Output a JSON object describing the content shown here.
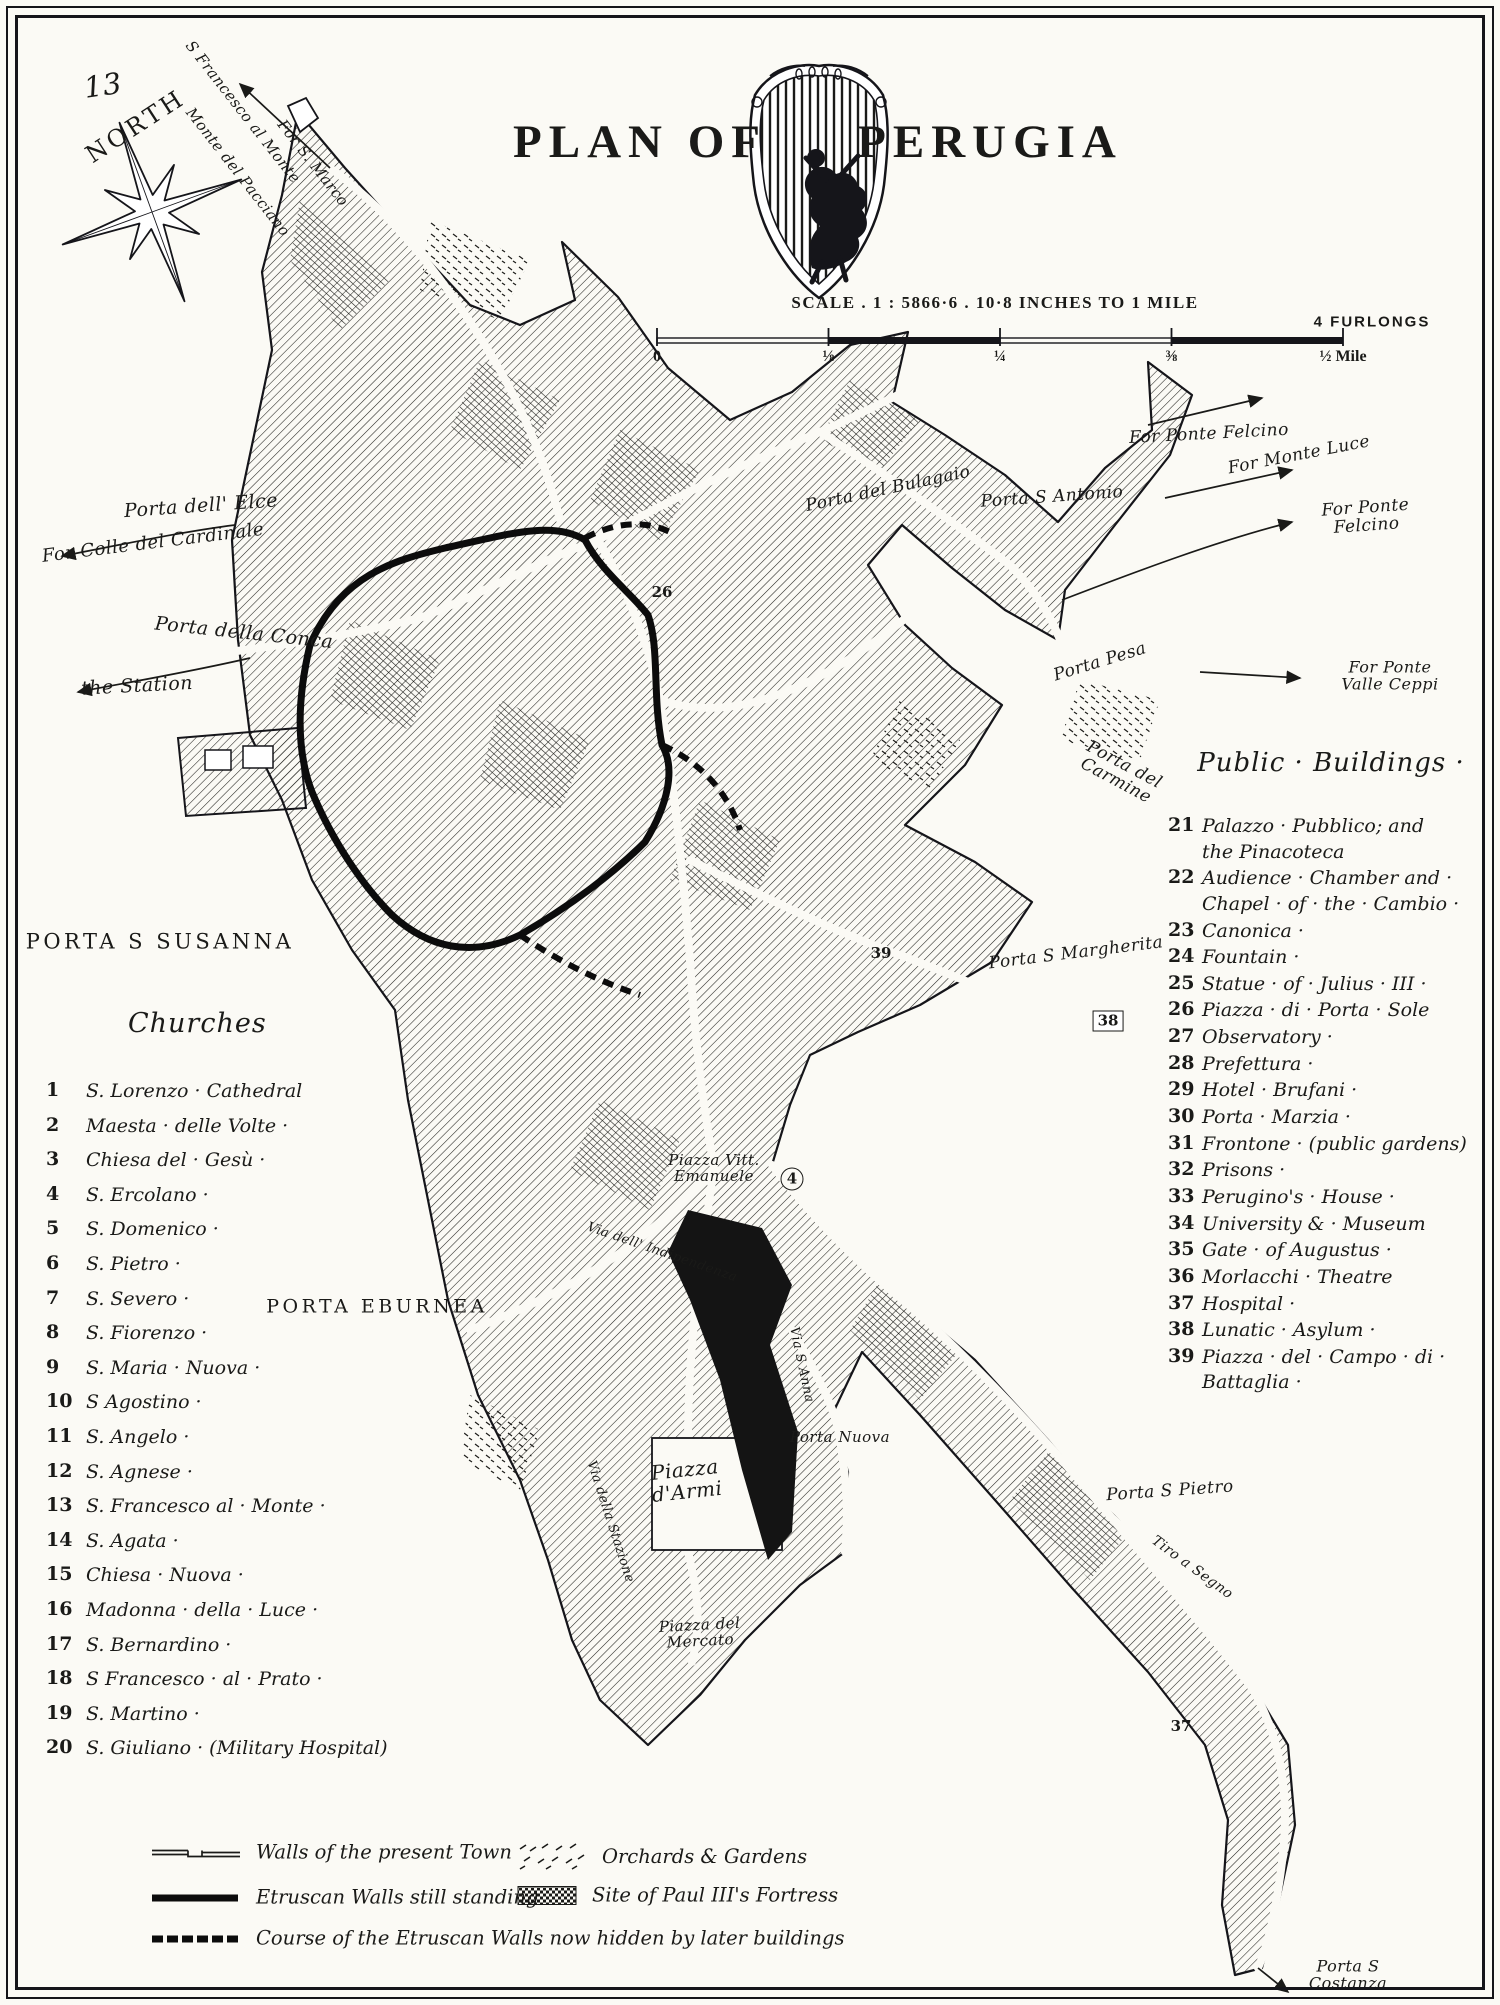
{
  "title": {
    "plan_of": "PLAN OF",
    "perugia": "PERUGIA"
  },
  "compass": {
    "label": "NORTH",
    "page_number": "13"
  },
  "scale": {
    "caption": "SCALE . 1 : 5866·6 . 10·8 INCHES TO 1 MILE",
    "furlongs": "4 FURLONGS",
    "ticks": [
      "0",
      "⅛",
      "¼",
      "⅜",
      "½ Mile"
    ]
  },
  "churches": {
    "heading": "Churches",
    "items": [
      {
        "num": "1",
        "name": "S. Lorenzo · Cathedral"
      },
      {
        "num": "2",
        "name": "Maesta · delle Volte ·"
      },
      {
        "num": "3",
        "name": "Chiesa del · Gesù ·"
      },
      {
        "num": "4",
        "name": "S. Ercolano ·"
      },
      {
        "num": "5",
        "name": "S. Domenico ·"
      },
      {
        "num": "6",
        "name": "S. Pietro ·"
      },
      {
        "num": "7",
        "name": "S. Severo ·"
      },
      {
        "num": "8",
        "name": "S. Fiorenzo ·"
      },
      {
        "num": "9",
        "name": "S. Maria · Nuova ·"
      },
      {
        "num": "10",
        "name": "S Agostino ·"
      },
      {
        "num": "11",
        "name": "S. Angelo ·"
      },
      {
        "num": "12",
        "name": "S. Agnese ·"
      },
      {
        "num": "13",
        "name": "S. Francesco al · Monte ·"
      },
      {
        "num": "14",
        "name": "S. Agata ·"
      },
      {
        "num": "15",
        "name": "Chiesa · Nuova ·"
      },
      {
        "num": "16",
        "name": "Madonna · della · Luce ·"
      },
      {
        "num": "17",
        "name": "S. Bernardino ·"
      },
      {
        "num": "18",
        "name": "S Francesco · al · Prato ·"
      },
      {
        "num": "19",
        "name": "S. Martino ·"
      },
      {
        "num": "20",
        "name": "S. Giuliano · (Military Hospital)"
      }
    ]
  },
  "public_buildings": {
    "heading": "Public · Buildings ·",
    "items": [
      {
        "num": "21",
        "name": "Palazzo · Pubblico; and\nthe Pinacoteca"
      },
      {
        "num": "22",
        "name": "Audience · Chamber and ·\nChapel · of · the · Cambio ·"
      },
      {
        "num": "23",
        "name": "Canonica ·"
      },
      {
        "num": "24",
        "name": "Fountain ·"
      },
      {
        "num": "25",
        "name": "Statue · of · Julius · III ·"
      },
      {
        "num": "26",
        "name": "Piazza · di · Porta · Sole"
      },
      {
        "num": "27",
        "name": "Observatory ·"
      },
      {
        "num": "28",
        "name": "Prefettura ·"
      },
      {
        "num": "29",
        "name": "Hotel · Brufani ·"
      },
      {
        "num": "30",
        "name": "Porta · Marzia ·"
      },
      {
        "num": "31",
        "name": "Frontone · (public gardens)"
      },
      {
        "num": "32",
        "name": "Prisons ·"
      },
      {
        "num": "33",
        "name": "Perugino's · House ·"
      },
      {
        "num": "34",
        "name": "University & · Museum"
      },
      {
        "num": "35",
        "name": "Gate · of Augustus ·"
      },
      {
        "num": "36",
        "name": "Morlacchi · Theatre"
      },
      {
        "num": "37",
        "name": "Hospital ·"
      },
      {
        "num": "38",
        "name": "Lunatic · Asylum ·"
      },
      {
        "num": "39",
        "name": "Piazza · del · Campo · di ·\nBattaglia ·"
      }
    ]
  },
  "legend": {
    "col1": [
      {
        "key": "present-walls",
        "label": "Walls of the present Town"
      },
      {
        "key": "etruscan-walls",
        "label": "Etruscan Walls still standing"
      },
      {
        "key": "etruscan-hidden",
        "label": "Course of the Etruscan Walls now hidden by later buildings"
      }
    ],
    "col2": [
      {
        "key": "orchards",
        "label": "Orchards & Gardens"
      },
      {
        "key": "fortress",
        "label": "Site of Paul III's Fortress"
      }
    ]
  },
  "map_labels": [
    {
      "text": "13",
      "x": 103,
      "y": 86,
      "rot": -8,
      "fs": 29
    },
    {
      "text": "NORTH",
      "x": 136,
      "y": 127,
      "rot": -33,
      "fs": 24,
      "cls": "caps"
    },
    {
      "text": "S Francesco al Monte",
      "x": 243,
      "y": 112,
      "rot": 52,
      "fs": 15
    },
    {
      "text": "Monte del Pacciano",
      "x": 238,
      "y": 172,
      "rot": 52,
      "fs": 15
    },
    {
      "text": "For S. Marco",
      "x": 313,
      "y": 163,
      "rot": 52,
      "fs": 15
    },
    {
      "text": "Porta dell' Elce",
      "x": 201,
      "y": 506,
      "rot": -4,
      "fs": 19
    },
    {
      "text": "For Colle del Cardinale",
      "x": 153,
      "y": 543,
      "rot": -7,
      "fs": 18
    },
    {
      "text": "Porta della Conca",
      "x": 244,
      "y": 633,
      "rot": 6,
      "fs": 19
    },
    {
      "text": "the Station",
      "x": 137,
      "y": 686,
      "rot": -3,
      "fs": 19
    },
    {
      "text": "Porta del Bulagaio",
      "x": 888,
      "y": 489,
      "rot": -12,
      "fs": 17
    },
    {
      "text": "Porta S Antonio",
      "x": 1052,
      "y": 497,
      "rot": -4,
      "fs": 17
    },
    {
      "text": "For Ponte Felcino",
      "x": 1209,
      "y": 434,
      "rot": -3,
      "fs": 17
    },
    {
      "text": "For Monte Luce",
      "x": 1299,
      "y": 455,
      "rot": -11,
      "fs": 17
    },
    {
      "text": "For Ponte Felcino",
      "x": 1366,
      "y": 517,
      "rot": -4,
      "fs": 17
    },
    {
      "text": "Porta Pesa",
      "x": 1100,
      "y": 662,
      "rot": -17,
      "fs": 17
    },
    {
      "text": "For Ponte Valle Ceppi",
      "x": 1390,
      "y": 676,
      "rot": 0,
      "fs": 16
    },
    {
      "text": "Porta del\nCarmine",
      "x": 1120,
      "y": 773,
      "rot": 28,
      "fs": 17
    },
    {
      "text": "Porta S Margherita",
      "x": 1076,
      "y": 953,
      "rot": -7,
      "fs": 17
    },
    {
      "text": "PORTA S SUSANNA",
      "x": 160,
      "y": 942,
      "rot": 0,
      "fs": 21,
      "cls": "caps"
    },
    {
      "text": "PORTA EBURNEA",
      "x": 377,
      "y": 1307,
      "rot": 0,
      "fs": 19,
      "cls": "caps"
    },
    {
      "text": "Piazza Vitt.\nEmanuele",
      "x": 714,
      "y": 1168,
      "rot": 0,
      "fs": 15
    },
    {
      "text": "Via dell' Indipendenza",
      "x": 662,
      "y": 1253,
      "rot": 19,
      "fs": 13
    },
    {
      "text": "Via S Anna",
      "x": 801,
      "y": 1365,
      "rot": 78,
      "fs": 13
    },
    {
      "text": "Porta Nuova",
      "x": 840,
      "y": 1437,
      "rot": 0,
      "fs": 15
    },
    {
      "text": "Piazza\nd'Armi",
      "x": 686,
      "y": 1481,
      "rot": -6,
      "fs": 20
    },
    {
      "text": "Via della Stazione",
      "x": 610,
      "y": 1522,
      "rot": 72,
      "fs": 13
    },
    {
      "text": "Piazza del\nMercato",
      "x": 700,
      "y": 1633,
      "rot": -3,
      "fs": 15
    },
    {
      "text": "Porta S Pietro",
      "x": 1170,
      "y": 1491,
      "rot": -4,
      "fs": 17
    },
    {
      "text": "Tiro a Segno",
      "x": 1192,
      "y": 1568,
      "rot": 36,
      "fs": 14
    },
    {
      "text": "Porta S\nCostanza",
      "x": 1348,
      "y": 1975,
      "rot": 0,
      "fs": 16
    }
  ],
  "map_numbers": [
    {
      "n": "26",
      "x": 662,
      "y": 592
    },
    {
      "n": "4",
      "x": 792,
      "y": 1179,
      "shape": "circle"
    },
    {
      "n": "39",
      "x": 881,
      "y": 953
    },
    {
      "n": "38",
      "x": 1108,
      "y": 1021,
      "shape": "box"
    },
    {
      "n": "37",
      "x": 1181,
      "y": 1726
    }
  ],
  "colors": {
    "ink": "#1a1a18",
    "paper": "#fbfaf5"
  }
}
